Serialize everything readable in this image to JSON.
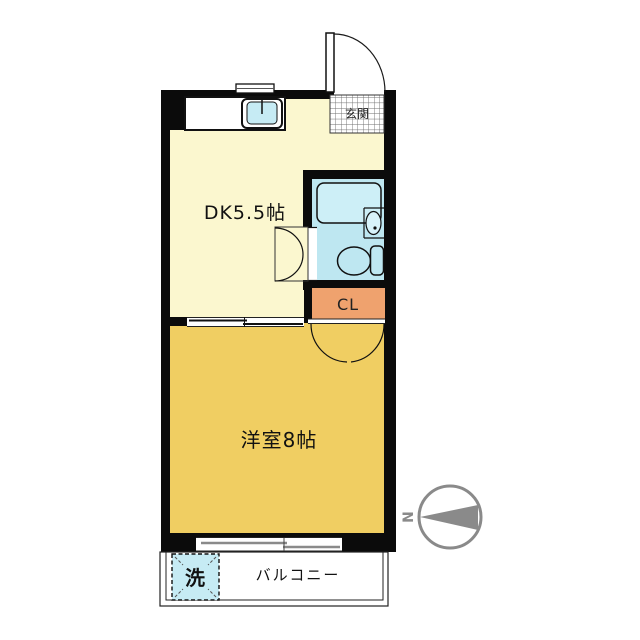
{
  "floorplan": {
    "rooms": {
      "dining_kitchen": {
        "label": "DK5.5帖"
      },
      "western_room": {
        "label": "洋室8帖"
      },
      "closet": {
        "label": "CL"
      },
      "entrance": {
        "label": "玄関"
      },
      "balcony": {
        "label": "バルコニー"
      },
      "washing_machine": {
        "label": "洗"
      }
    },
    "compass": {
      "north_label": "N"
    },
    "colors": {
      "dk_floor": "#FBF7CF",
      "western_room_floor": "#F0CE62",
      "closet_fill": "#EFA26E",
      "bathroom_fill": "#BEE7F1",
      "bathtub_fill": "#CDEFF7",
      "washer_fill": "#C6EBF4",
      "wall": "#0B0B0B",
      "compass_gray": "#8A8A8A"
    }
  }
}
